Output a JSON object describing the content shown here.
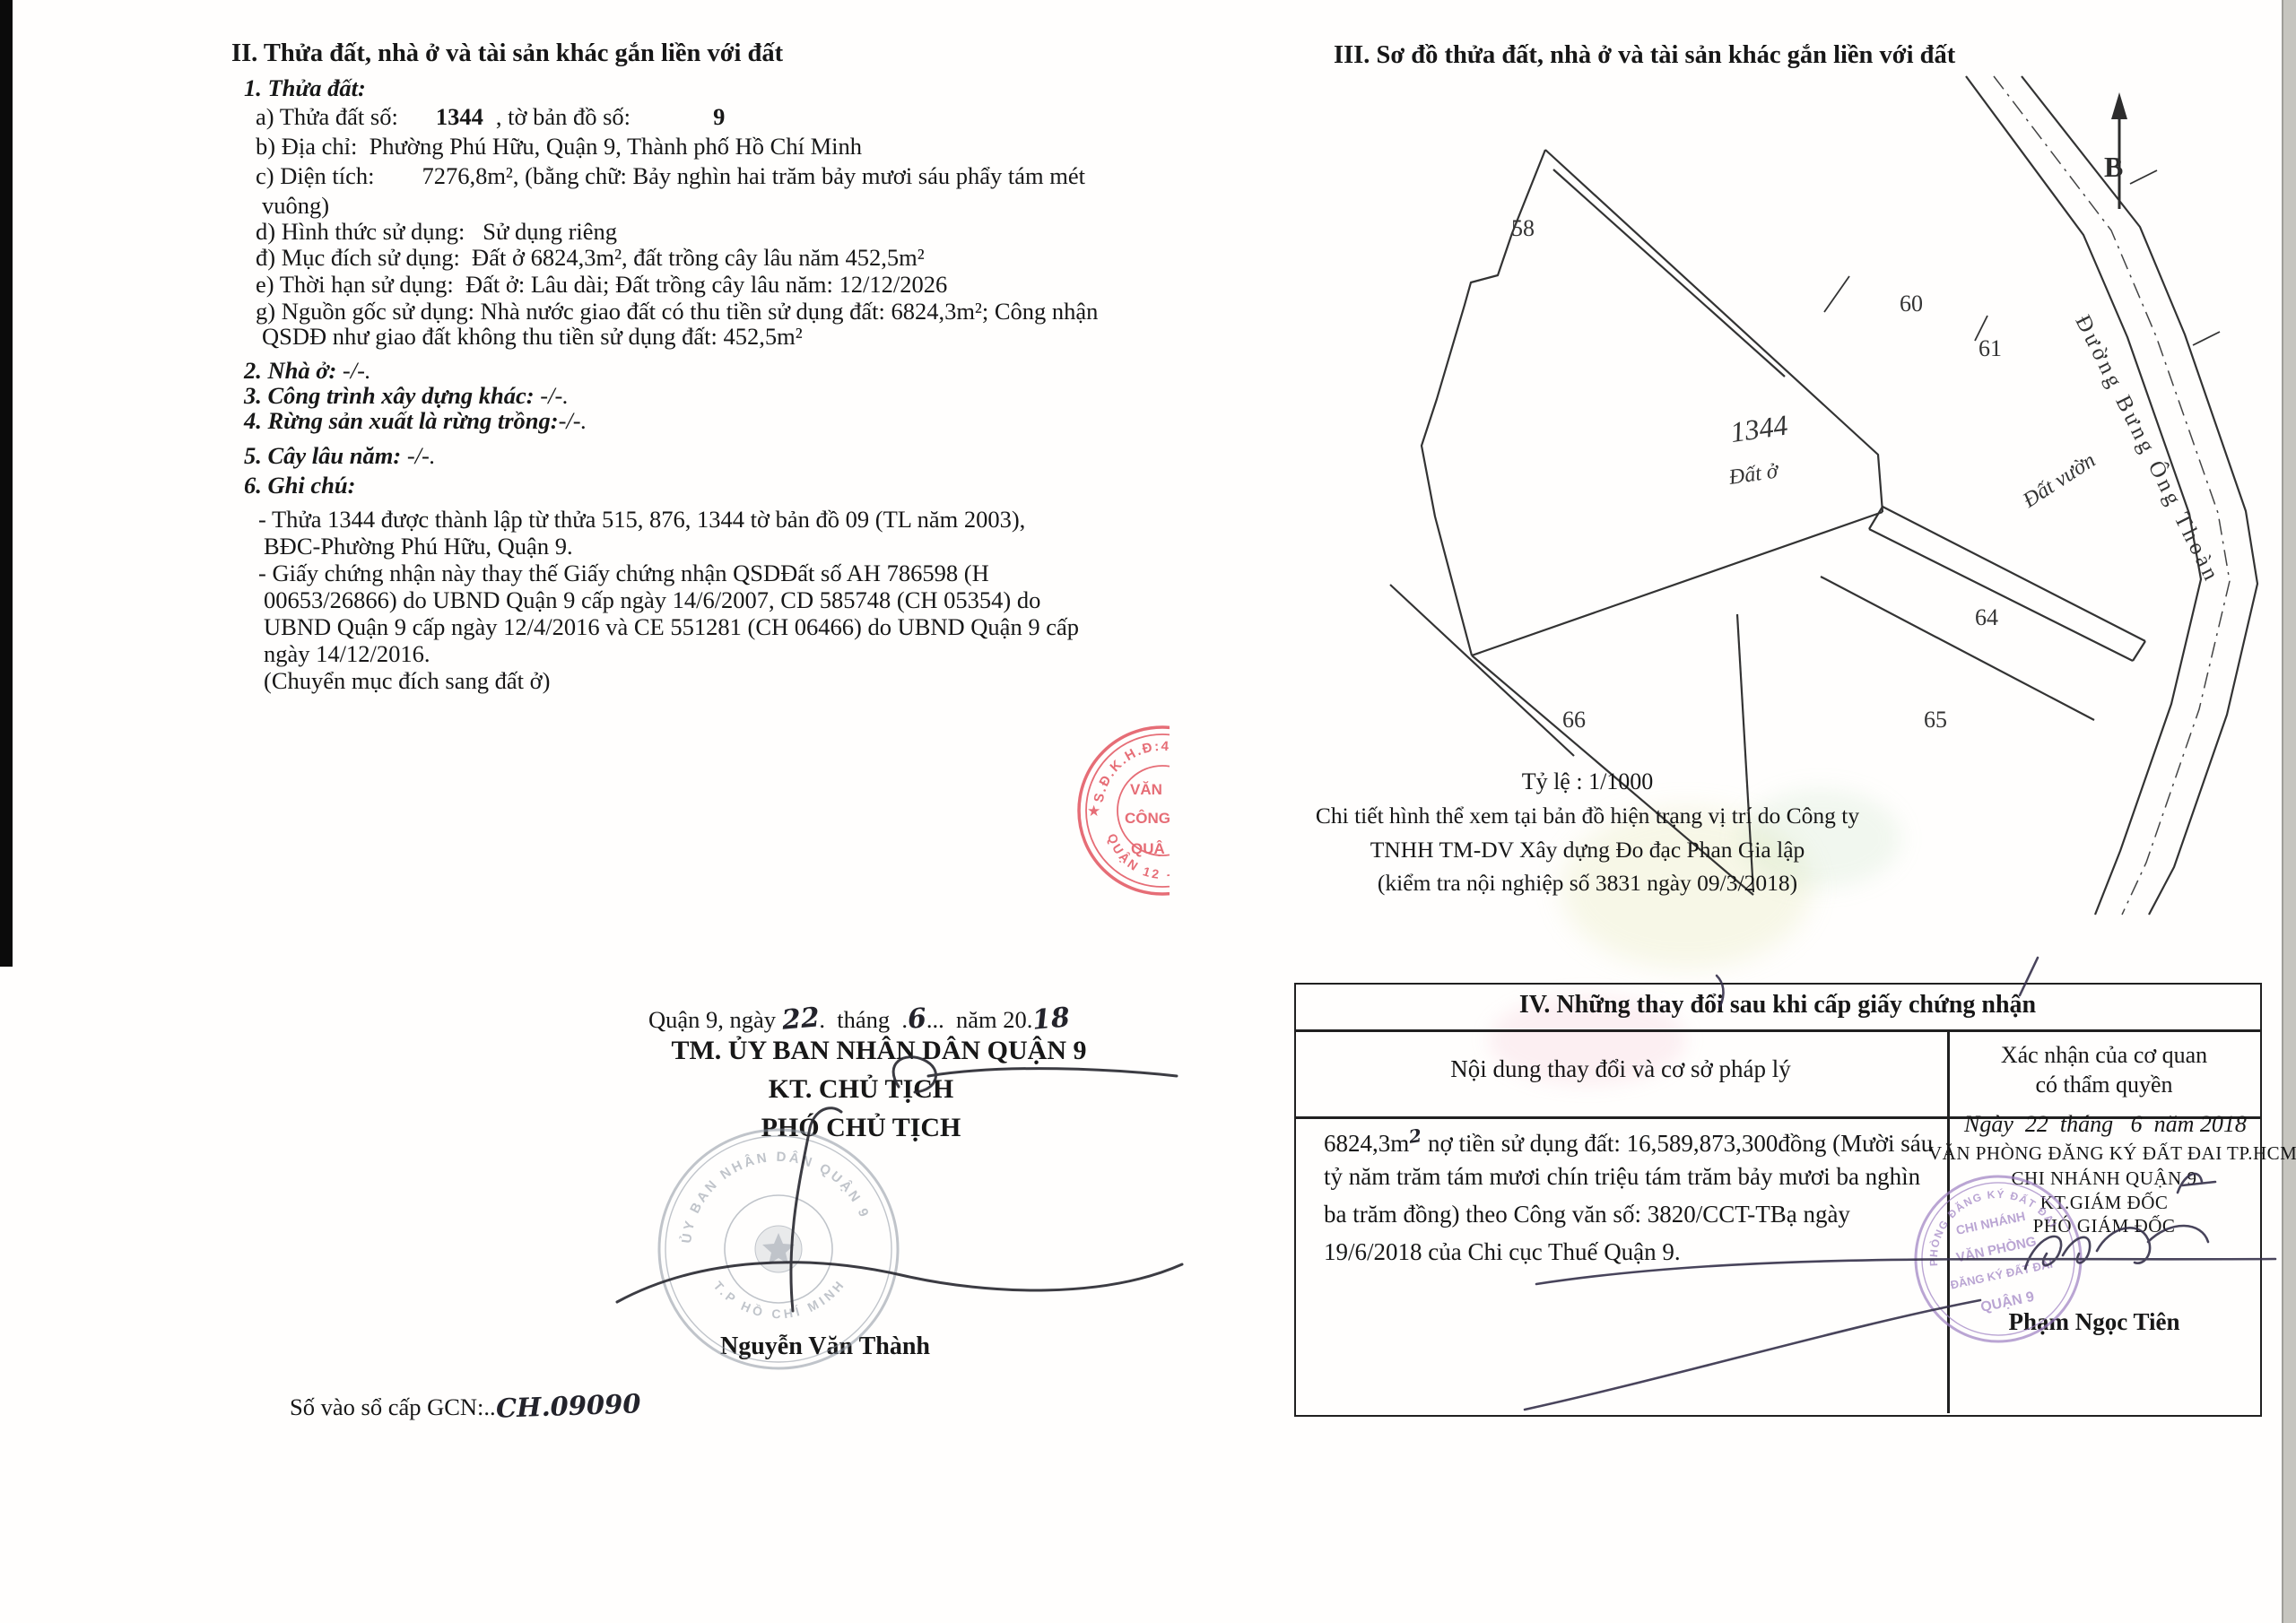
{
  "s2": {
    "heading": "II. Thửa đất, nhà ở và tài sản khác gắn liền với đất",
    "item1": "1. Thửa đất:",
    "a_pre": "a) Thửa đất số:",
    "a_num": "1344",
    "a_mid": ", tờ bản đồ số:",
    "a_num2": "9",
    "b": "b) Địa chỉ:  Phường Phú Hữu, Quận 9, Thành phố Hồ Chí Minh",
    "c1": "c) Diện tích:        7276,8m², (bằng chữ: Bảy nghìn hai trăm bảy mươi sáu phẩy tám mét",
    "c2": "vuông)",
    "d": "d) Hình thức sử dụng:   Sử dụng riêng",
    "dd": "đ) Mục đích sử dụng:  Đất ở 6824,3m², đất trồng cây lâu năm 452,5m²",
    "e": "e) Thời hạn sử dụng:  Đất ở: Lâu dài; Đất trồng cây lâu năm: 12/12/2026",
    "g1": "g) Nguồn gốc sử dụng: Nhà nước giao đất có thu tiền sử dụng đất: 6824,3m²; Công nhận",
    "g2": "QSDĐ như giao đất không thu tiền sử dụng đất: 452,5m²",
    "item2": "2. Nhà ở:",
    "item2_v": " -/-.",
    "item3": "3. Công trình xây dựng khác:",
    "item3_v": " -/-.",
    "item4": "4. Rừng sản xuất là rừng trồng:",
    "item4_v": "-/-.",
    "item5": "5. Cây lâu năm:",
    "item5_v": " -/-.",
    "item6": "6. Ghi chú:",
    "n1a": "- Thửa 1344 được thành lập từ thửa 515, 876, 1344 tờ bản đồ 09 (TL năm 2003),",
    "n1b": "BĐC-Phường Phú Hữu, Quận 9.",
    "n2a": "- Giấy chứng nhận này thay thế Giấy chứng nhận QSDĐất số AH 786598 (H",
    "n2b": "00653/26866) do UBND Quận 9 cấp ngày 14/6/2007, CD 585748 (CH 05354) do",
    "n2c": "UBND Quận 9 cấp ngày 12/4/2016 và CE 551281 (CH 06466) do UBND Quận 9 cấp",
    "n2d": "ngày 14/12/2016.",
    "n3": "(Chuyển mục đích sang đất ở)"
  },
  "sign": {
    "date_p1": "Quận 9, ngày ",
    "date_d": "22",
    "date_p2": ".  tháng  .",
    "date_m": "6",
    "date_p3": "...  năm 20.",
    "date_y": "18",
    "committee": "TM. ỦY BAN NHÂN DÂN QUẬN 9",
    "kt": "KT. CHỦ TỊCH",
    "deputy": "PHÓ CHỦ TỊCH",
    "signer": "Nguyễn Văn Thành",
    "book_label": "Số vào sổ cấp GCN:..",
    "book_value": "CH.09090"
  },
  "red_stamp": {
    "arc_top": "S.Đ.K.H.Đ:410",
    "star": "★",
    "arc_bottom": "QUẬN 12 -",
    "line1": "VĂN",
    "line2": "CÔNG",
    "line3": "QUẬ"
  },
  "gray_stamp": {
    "arc_top": "ỦY BAN NHÂN DÂN QUẬN 9",
    "arc_bottom": "T.P HỒ CHÍ MINH"
  },
  "s3": {
    "heading": "III. Sơ đồ thửa đất, nhà ở và tài sản khác gắn liền với đất",
    "map": {
      "north": "B",
      "p58": "58",
      "p60": "60",
      "p61": "61",
      "p64": "64",
      "p65": "65",
      "p66": "66",
      "parcel": "1344",
      "parcel_use": "Đất ở",
      "garden": "Đất vườn",
      "road": "Đường Bưng Ông Thoàn"
    },
    "caption1": "Tỷ lệ : 1/1000",
    "caption2": "Chi tiết hình thể xem tại bản đồ hiện trạng vị trí do Công ty",
    "caption3": "TNHH TM-DV Xây dựng Đo đạc Phan Gia lập",
    "caption4": "(kiểm tra nội nghiệp số 3831 ngày 09/3/2018)"
  },
  "s4": {
    "heading": "IV. Những thay đổi sau khi cấp giấy chứng nhận",
    "col1": "Nội dung thay đổi và cơ sở pháp lý",
    "col2a": "Xác nhận của cơ quan",
    "col2b": "có thẩm quyền",
    "body1a": "6824,3m",
    "body1sup": "2",
    "body1b": " nợ tiền sử dụng đất: 16,589,873,300đồng (Mười sáu",
    "body2": "tỷ năm trăm tám mươi chín triệu tám trăm bảy mươi ba nghìn",
    "body3": "ba trăm đồng) theo Công văn số: 3820/CCT-TBạ ngày",
    "body4": "19/6/2018 của Chi cục Thuế Quận 9.",
    "right_date": "Ngày  22  tháng   6  năm 2018",
    "right_org1": "VĂN PHÒNG ĐĂNG KÝ ĐẤT ĐAI TP.HCM",
    "right_org2": "CHI NHÁNH QUẬN 9",
    "right_kt": "KT.GIÁM ĐỐC",
    "right_deputy": "PHÓ GIÁM ĐỐC",
    "right_signer": "Phạm Ngọc Tiên"
  },
  "purple_stamp": {
    "arc_top": "PHÒNG ĐĂNG KÝ ĐẤT ĐAI",
    "l1": "CHI NHÁNH",
    "l2": "VĂN PHÒNG",
    "l3": "ĐĂNG KÝ ĐẤT ĐAI",
    "l4": "QUẬN 9"
  }
}
